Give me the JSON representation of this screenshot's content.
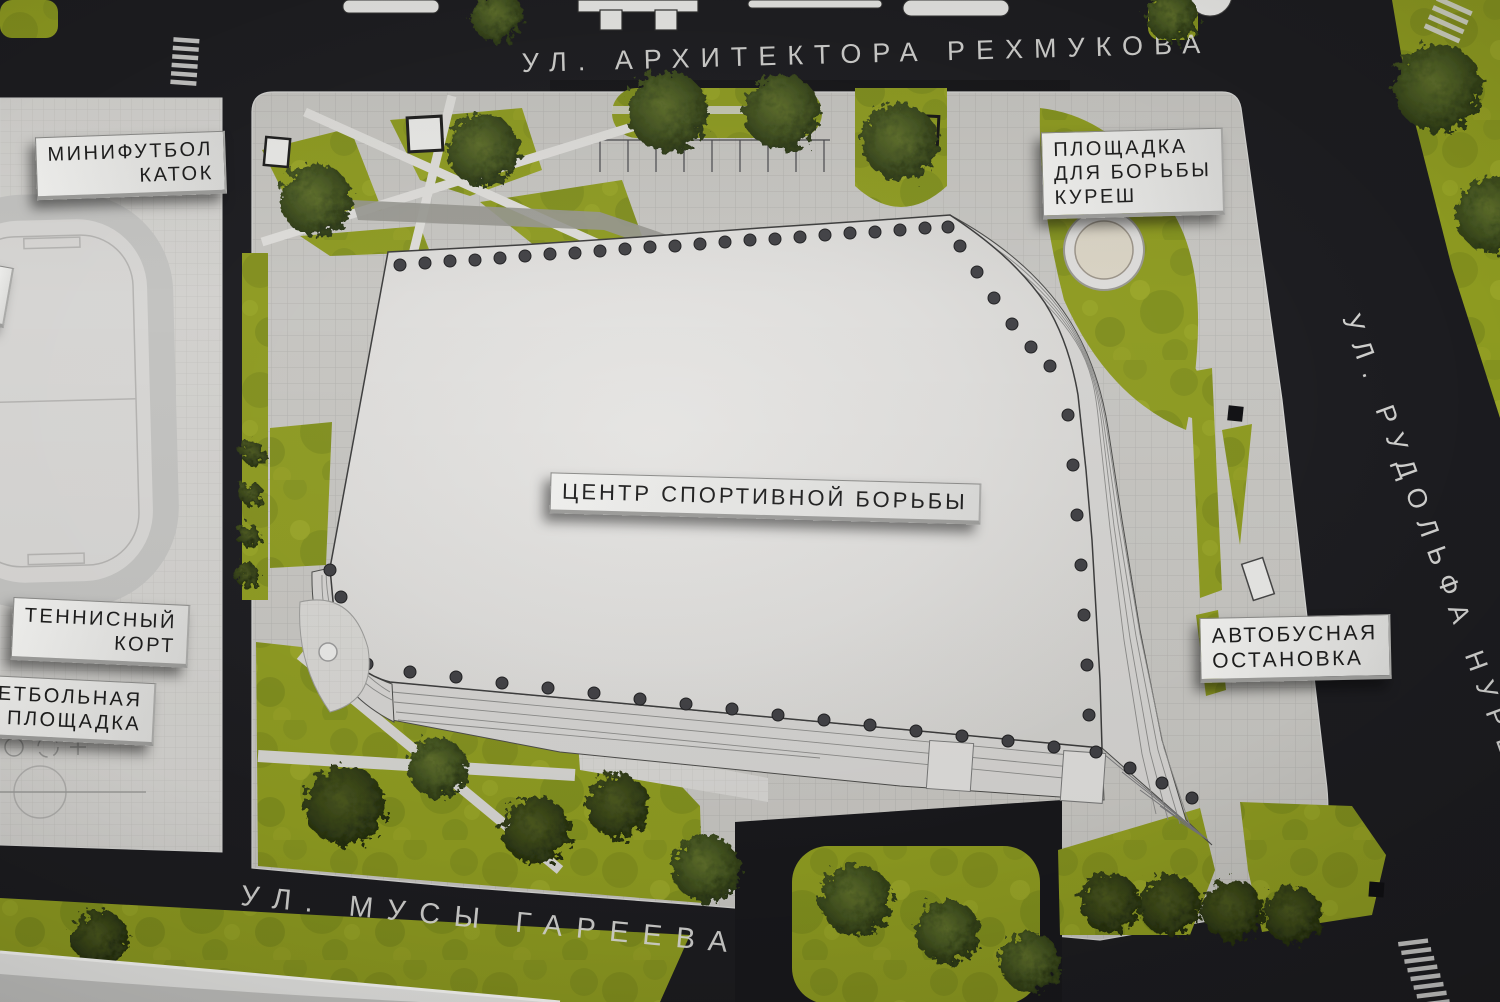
{
  "streets": {
    "top": "УЛ. АРХИТЕКТОРА РЕХМУКОВА",
    "bottom": "УЛ. МУСЫ ГАРЕЕВА",
    "right": "УЛ. РУДОЛЬФА НУРЕЕВА"
  },
  "labels": {
    "minifootball_rink": {
      "line1": "МИНИФУТБОЛ",
      "line2": "КАТОК"
    },
    "kuresh_area": {
      "line1": "ПЛОЩАДКА",
      "line2": "ДЛЯ БОРЬБЫ",
      "line3": "КУРЕШ"
    },
    "wrestling_center": {
      "text": "ЦЕНТР СПОРТИВНОЙ БОРЬБЫ"
    },
    "tennis_court": {
      "line1": "ТЕННИСНЫЙ",
      "line2": "КОРТ"
    },
    "basketball_court": {
      "line1": "КЕТБОЛЬНАЯ",
      "line2": "ПЛОЩАДКА"
    },
    "bus_stop": {
      "line1": "АВТОБУСНАЯ",
      "line2": "ОСТАНОВКА"
    }
  },
  "colors": {
    "asphalt": "#1b1b1f",
    "lawn": "#8d9a20",
    "paving": "#c9c8c4",
    "building": "#dddcda",
    "plaque": "#e9e9e7",
    "street_text": "#dcdcda"
  }
}
